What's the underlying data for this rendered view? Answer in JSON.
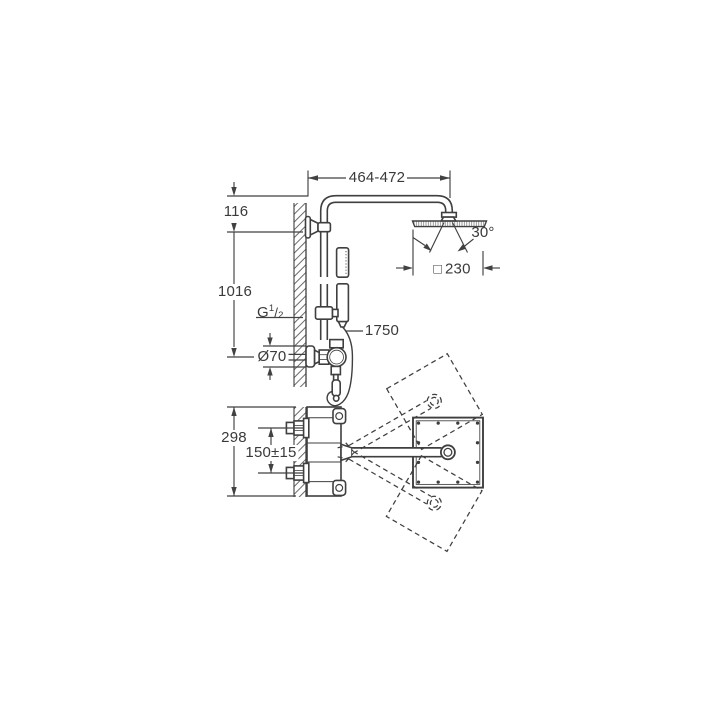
{
  "meta": {
    "background_color": "#ffffff",
    "line_color": "#414141",
    "text_color": "#3a3a3a"
  },
  "labels": {
    "top_width": "464-472",
    "wall_offset": "116",
    "riser_height": "1016",
    "thread_prefix": "G",
    "thread_numerator": "1",
    "thread_slash": "/",
    "thread_denominator": "2",
    "escutcheon_diameter": "Ø70",
    "hose_length": "1750",
    "swivel_angle": "30°",
    "head_square_symbol": "□",
    "head_size": "230",
    "valve_height": "298",
    "inlet_spacing": "150±15"
  }
}
